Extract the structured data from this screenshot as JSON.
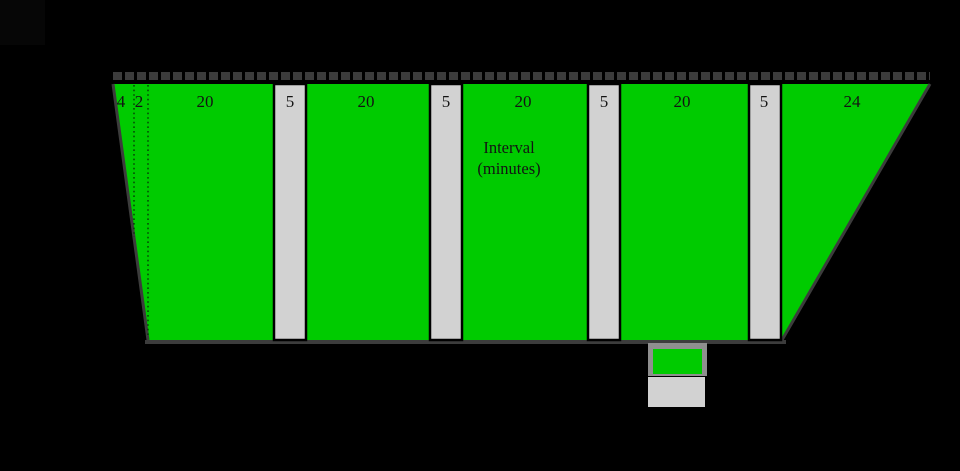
{
  "colors": {
    "background": "#000000",
    "segment_green": "#00cb00",
    "segment_gray": "#d2d2d2",
    "outline_gray": "#3c3c3c",
    "legend_border_gray": "#8f8f8f",
    "label_text": "#131313"
  },
  "timeline": {
    "title": "",
    "axis_label_line1": "Interval",
    "axis_label_line2": "(minutes)",
    "total_minutes": 130,
    "segments": [
      {
        "label": "4",
        "minutes": 4,
        "color": "green"
      },
      {
        "label": "2",
        "minutes": 2,
        "color": "green"
      },
      {
        "label": "20",
        "minutes": 20,
        "color": "green"
      },
      {
        "label": "5",
        "minutes": 5,
        "color": "gray"
      },
      {
        "label": "20",
        "minutes": 20,
        "color": "green"
      },
      {
        "label": "5",
        "minutes": 5,
        "color": "gray"
      },
      {
        "label": "20",
        "minutes": 20,
        "color": "green"
      },
      {
        "label": "5",
        "minutes": 5,
        "color": "gray"
      },
      {
        "label": "20",
        "minutes": 20,
        "color": "green"
      },
      {
        "label": "5",
        "minutes": 5,
        "color": "gray"
      },
      {
        "label": "24",
        "minutes": 24,
        "color": "green"
      }
    ]
  },
  "legend": {
    "items": [
      {
        "swatch_color": "#00cb00"
      },
      {
        "swatch_color": "#d2d2d2"
      }
    ]
  }
}
